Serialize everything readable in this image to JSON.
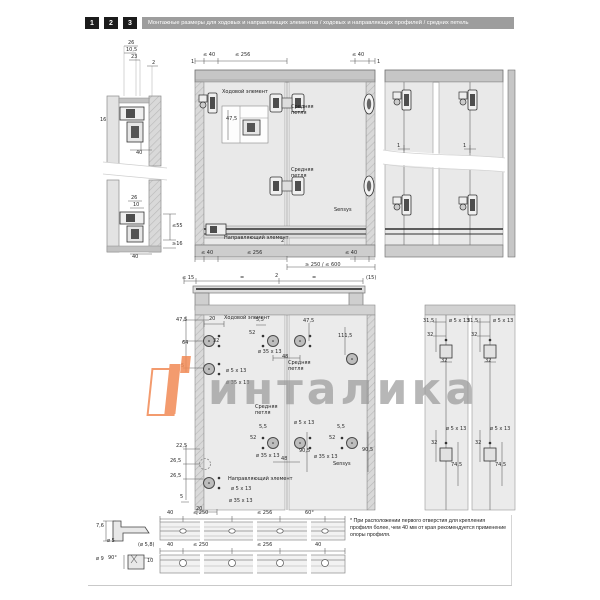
{
  "header": {
    "steps": [
      "1",
      "2",
      "3"
    ],
    "title": "Монтажные размеры для ходовых и направляющих элементов / ходовых и направляющих профилей / средних петель"
  },
  "watermark": {
    "text": "инталика"
  },
  "footnote": {
    "text": "* При расположении первого отверстия для крепления профиля более, чем 40 мм от края рекомендуется применение опоры профиля."
  },
  "colors": {
    "accent_orange": "#f28a55",
    "header_bar": "#9d9d9d",
    "watermark_gray": "#a8a8a8"
  },
  "annotations": [
    {
      "t": "26",
      "x": 128,
      "y": 41
    },
    {
      "t": "10,5",
      "x": 126,
      "y": 48
    },
    {
      "t": "23",
      "x": 131,
      "y": 55
    },
    {
      "t": "2",
      "x": 152,
      "y": 61
    },
    {
      "t": "16",
      "x": 100,
      "y": 118
    },
    {
      "t": "40",
      "x": 136,
      "y": 151
    },
    {
      "t": "26",
      "x": 131,
      "y": 196
    },
    {
      "t": "10",
      "x": 133,
      "y": 203
    },
    {
      "t": "≤55",
      "x": 172,
      "y": 224
    },
    {
      "t": "≥16",
      "x": 172,
      "y": 242
    },
    {
      "t": "40",
      "x": 132,
      "y": 255
    },
    {
      "t": "≤ 40",
      "x": 203,
      "y": 53
    },
    {
      "t": "≤ 256",
      "x": 235,
      "y": 53
    },
    {
      "t": "≤ 40",
      "x": 352,
      "y": 53
    },
    {
      "t": "1",
      "x": 191,
      "y": 60
    },
    {
      "t": "1",
      "x": 377,
      "y": 60
    },
    {
      "t": "Ходовой элемент",
      "x": 222,
      "y": 90,
      "c": "co",
      "n": "callout-running-element"
    },
    {
      "t": "Средняя\nпетля",
      "x": 291,
      "y": 105,
      "c": "co",
      "n": "callout-middle-hinge"
    },
    {
      "t": "47,5",
      "x": 226,
      "y": 117
    },
    {
      "t": "Средняя\nпетля",
      "x": 291,
      "y": 168,
      "c": "co",
      "n": "callout-middle-hinge"
    },
    {
      "t": "Sensys",
      "x": 334,
      "y": 208,
      "c": "co",
      "n": "callout-sensys"
    },
    {
      "t": "Направляющий элемент",
      "x": 224,
      "y": 236,
      "c": "co",
      "n": "callout-guide-element"
    },
    {
      "t": "2",
      "x": 281,
      "y": 239
    },
    {
      "t": "≤ 40",
      "x": 201,
      "y": 251
    },
    {
      "t": "≤ 256",
      "x": 247,
      "y": 251
    },
    {
      "t": "≤ 40",
      "x": 345,
      "y": 251
    },
    {
      "t": "≥ 250 / ≤ 600",
      "x": 305,
      "y": 263
    },
    {
      "t": "≤ 15",
      "x": 182,
      "y": 276
    },
    {
      "t": "=",
      "x": 240,
      "y": 276
    },
    {
      "t": "2",
      "x": 275,
      "y": 274
    },
    {
      "t": "=",
      "x": 312,
      "y": 276
    },
    {
      "t": "(15)",
      "x": 366,
      "y": 276
    },
    {
      "t": "1",
      "x": 397,
      "y": 144
    },
    {
      "t": "1",
      "x": 463,
      "y": 144
    },
    {
      "t": "47,5",
      "x": 176,
      "y": 318
    },
    {
      "t": "20",
      "x": 209,
      "y": 317
    },
    {
      "t": "Ходовой элемент",
      "x": 224,
      "y": 316,
      "c": "co",
      "n": "callout-running-element"
    },
    {
      "t": "5,5",
      "x": 256,
      "y": 318
    },
    {
      "t": "52",
      "x": 249,
      "y": 331
    },
    {
      "t": "47,5",
      "x": 303,
      "y": 319
    },
    {
      "t": "32",
      "x": 213,
      "y": 339
    },
    {
      "t": "64",
      "x": 182,
      "y": 341
    },
    {
      "t": "5",
      "x": 181,
      "y": 364
    },
    {
      "t": "ø 5 x 13",
      "x": 226,
      "y": 369
    },
    {
      "t": "ø 35 x 13",
      "x": 226,
      "y": 381
    },
    {
      "t": "ø 35 x 13",
      "x": 258,
      "y": 350
    },
    {
      "t": "48",
      "x": 282,
      "y": 355
    },
    {
      "t": "111,5",
      "x": 338,
      "y": 334
    },
    {
      "t": "Средняя\nпетля",
      "x": 288,
      "y": 361,
      "c": "co",
      "n": "callout-middle-hinge"
    },
    {
      "t": "31,5",
      "x": 423,
      "y": 319
    },
    {
      "t": "32",
      "x": 427,
      "y": 333
    },
    {
      "t": "ø 5 x 13",
      "x": 449,
      "y": 319
    },
    {
      "t": "32",
      "x": 441,
      "y": 359
    },
    {
      "t": "31,5",
      "x": 467,
      "y": 319
    },
    {
      "t": "32",
      "x": 471,
      "y": 333
    },
    {
      "t": "ø 5 x 13",
      "x": 493,
      "y": 319
    },
    {
      "t": "32",
      "x": 485,
      "y": 359
    },
    {
      "t": "Средняя\nпетля",
      "x": 255,
      "y": 405,
      "c": "co",
      "n": "callout-middle-hinge"
    },
    {
      "t": "ø 5 x 13",
      "x": 294,
      "y": 421
    },
    {
      "t": "5,5",
      "x": 259,
      "y": 425
    },
    {
      "t": "52",
      "x": 250,
      "y": 436
    },
    {
      "t": "ø 35 x 13",
      "x": 256,
      "y": 454
    },
    {
      "t": "48",
      "x": 281,
      "y": 457
    },
    {
      "t": "90,5",
      "x": 299,
      "y": 449
    },
    {
      "t": "5,5",
      "x": 337,
      "y": 425
    },
    {
      "t": "52",
      "x": 329,
      "y": 436
    },
    {
      "t": "ø 35 x 13",
      "x": 314,
      "y": 455
    },
    {
      "t": "90,5",
      "x": 362,
      "y": 448
    },
    {
      "t": "Sensys",
      "x": 333,
      "y": 462,
      "c": "co",
      "n": "callout-sensys"
    },
    {
      "t": "22,5",
      "x": 176,
      "y": 444
    },
    {
      "t": "26,5",
      "x": 170,
      "y": 459
    },
    {
      "t": "26,5",
      "x": 170,
      "y": 474
    },
    {
      "t": "Направляющий элемент",
      "x": 228,
      "y": 477,
      "c": "co",
      "n": "callout-guide-element"
    },
    {
      "t": "ø 5 x 13",
      "x": 231,
      "y": 487
    },
    {
      "t": "ø 35 x 13",
      "x": 229,
      "y": 499
    },
    {
      "t": "5",
      "x": 180,
      "y": 495
    },
    {
      "t": "20",
      "x": 196,
      "y": 507
    },
    {
      "t": "ø 5 x 13",
      "x": 446,
      "y": 427
    },
    {
      "t": "32",
      "x": 431,
      "y": 441
    },
    {
      "t": "74,5",
      "x": 451,
      "y": 463
    },
    {
      "t": "ø 5 x 13",
      "x": 490,
      "y": 427
    },
    {
      "t": "32",
      "x": 475,
      "y": 441
    },
    {
      "t": "74,5",
      "x": 495,
      "y": 463
    },
    {
      "t": "7,6",
      "x": 96,
      "y": 524
    },
    {
      "t": "ø 5",
      "x": 107,
      "y": 539
    },
    {
      "t": "40",
      "x": 167,
      "y": 511
    },
    {
      "t": "≤ 250",
      "x": 193,
      "y": 511
    },
    {
      "t": "≤ 256",
      "x": 257,
      "y": 511
    },
    {
      "t": "60°",
      "x": 305,
      "y": 511
    },
    {
      "t": "(ø 5,8)",
      "x": 138,
      "y": 543
    },
    {
      "t": "40",
      "x": 167,
      "y": 543
    },
    {
      "t": "≤ 250",
      "x": 193,
      "y": 543
    },
    {
      "t": "≤ 256",
      "x": 257,
      "y": 543
    },
    {
      "t": "40",
      "x": 315,
      "y": 543
    },
    {
      "t": "ø 9",
      "x": 96,
      "y": 557
    },
    {
      "t": "90°",
      "x": 108,
      "y": 556
    },
    {
      "t": "10",
      "x": 147,
      "y": 559
    }
  ]
}
